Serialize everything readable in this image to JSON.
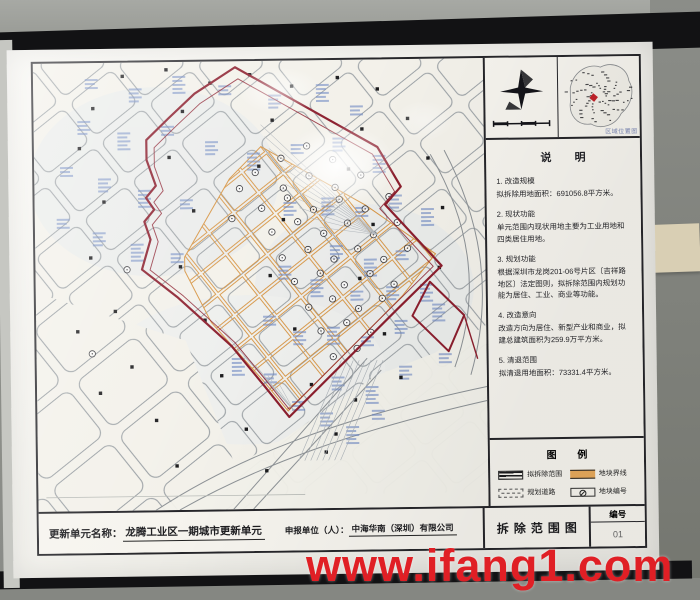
{
  "photo": {
    "watermark_text": "www.ifang1.com"
  },
  "board": {
    "inset": {
      "label": "区域位置图"
    },
    "notes": {
      "title": "说  明",
      "items": [
        {
          "heading": "1. 改造规模",
          "body": "拟拆除用地面积：691056.8平方米。"
        },
        {
          "heading": "2. 现状功能",
          "body": "单元范围内现状用地主要为工业用地和四类居住用地。"
        },
        {
          "heading": "3. 规划功能",
          "body": "根据深圳市龙岗201-06号片区〔吉祥路地区〕法定图则，拟拆除范围内规划功能为居住、工业、商业等功能。"
        },
        {
          "heading": "4. 改造意向",
          "body": "改造方向为居住、新型产业和商业，拟建总建筑面积为259.9万平方米。"
        },
        {
          "heading": "5. 清退范围",
          "body": "拟清退用地面积：73331.4平方米。"
        }
      ]
    },
    "legend": {
      "title": "图  例",
      "items": [
        {
          "label": "拟拆除范围"
        },
        {
          "label": "地块界线"
        },
        {
          "label": "规划道路"
        },
        {
          "label": "地块编号"
        }
      ]
    },
    "title_bar": {
      "unit_name_label": "更新单元名称：",
      "unit_name_value": "龙腾工业区一期城市更新单元",
      "applicant_label": "申报单位（人）：",
      "applicant_value": "中海华南（深圳）有限公司",
      "drawing_title": "拆除范围图",
      "number_label": "编号",
      "number_value": "01"
    },
    "colors": {
      "demolition_boundary": "#8c1f2e",
      "parcel_boundary": "#d79646",
      "map_annotation_blue": "#7089c4",
      "watermark_red": "#e01f25"
    }
  }
}
